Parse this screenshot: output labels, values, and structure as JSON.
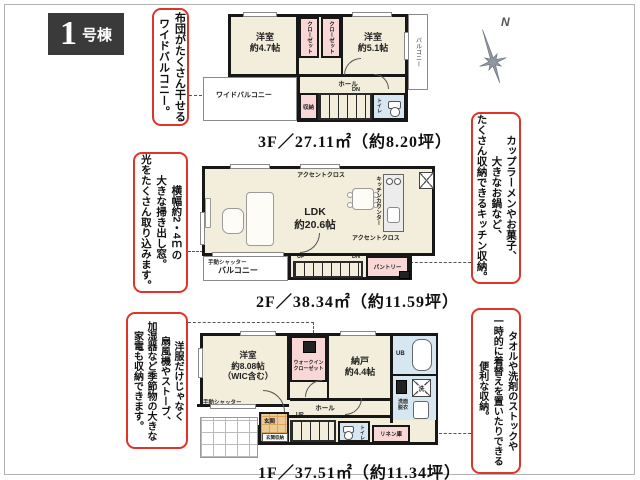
{
  "page": {
    "badge": {
      "number": "1",
      "suffix": "号棟"
    }
  },
  "compass": {
    "label": "N"
  },
  "notes": {
    "futon": "布団がたくさん干せる\nワイドバルコニー。",
    "window": "横幅約2・4ｍの\n大きな掃き出し窓。\n光をたくさん取り込みます。",
    "kitchen": "カップラーメンやお菓子、\n大きなお鍋など、\nたくさん収納できるキッチン収納。",
    "wic": "洋服だけじゃなく\n扇風機やストーブ、\n加湿器など季節物の大きな\n家電も収納できます。",
    "linen": "タオルや洗剤のストックや\n一時的に着替えを置いたりできる\n便利な収納。"
  },
  "floors": {
    "f3": {
      "area_label": "3F／27.11㎡（約8.20坪）",
      "rooms": {
        "bedroom_left": "洋室\n約4.7帖",
        "bedroom_right": "洋室\n約5.1帖",
        "closet": "クローゼット",
        "hall": "ホール",
        "dn": "DN",
        "storage": "収納",
        "toilet": "トイレ",
        "balcony_side": "バルコニー",
        "wide_balcony": "ワイドバルコニー"
      }
    },
    "f2": {
      "area_label": "2F／38.34㎡（約11.59坪）",
      "rooms": {
        "ldk": "LDK\n約20.6帖",
        "accent": "アクセントクロス",
        "kitchen_counter": "キッチンカウンター",
        "pantry": "パントリー",
        "balcony": "バルコニー",
        "shutter": "手動シャッター",
        "up": "UP",
        "dn": "DN"
      }
    },
    "f1": {
      "area_label": "1F／37.51㎡（約11.34坪）",
      "rooms": {
        "bedroom": "洋室\n約8.08帖\n（WIC含む）",
        "wic": "ウォークイン\nクローゼット",
        "storeroom": "納戸\n約4.4帖",
        "bath": "UB",
        "washroom": "洗面\n脱衣",
        "washer": "洗",
        "hall": "ホール",
        "toilet": "トイレ",
        "linen": "リネン庫",
        "entrance": "玄関",
        "entrance_storage": "玄関収納",
        "shutter": "手動シャッター",
        "up": "UP"
      }
    }
  }
}
